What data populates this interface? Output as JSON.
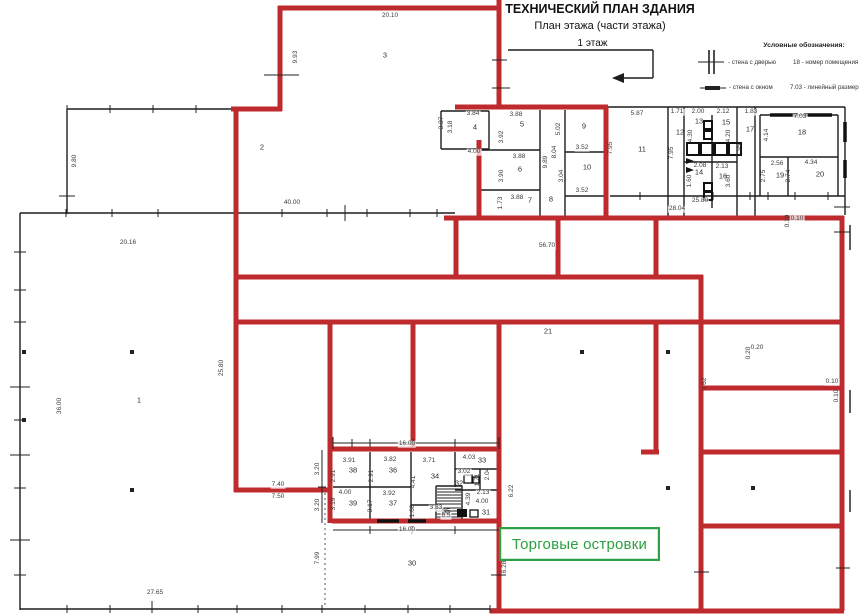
{
  "header": {
    "title": "ТЕХНИЧЕСКИЙ ПЛАН ЗДАНИЯ",
    "subtitle": "План этажа (части этажа)",
    "floor": "1 этаж"
  },
  "legend": {
    "title": "Условные обозначения:",
    "door_label": "- стена с дверью",
    "room_number_label": "18 - номер помещения",
    "window_label": "- стена с окном",
    "dimension_label": "7.03 - линейный размер"
  },
  "overlay": {
    "label": "Торговые островки"
  },
  "colors": {
    "wall_red": "#bf2a2e",
    "wall_black": "#1d1d1d",
    "green": "#2f9e44",
    "dim_text": "#3a3a3a"
  },
  "floor_plan": {
    "room_numbers": [
      {
        "t": "1",
        "x": 139,
        "y": 400
      },
      {
        "t": "2",
        "x": 262,
        "y": 147
      },
      {
        "t": "3",
        "x": 385,
        "y": 55
      },
      {
        "t": "4",
        "x": 475,
        "y": 127
      },
      {
        "t": "5",
        "x": 522,
        "y": 124
      },
      {
        "t": "6",
        "x": 520,
        "y": 169
      },
      {
        "t": "7",
        "x": 530,
        "y": 200
      },
      {
        "t": "8",
        "x": 551,
        "y": 199
      },
      {
        "t": "9",
        "x": 584,
        "y": 126
      },
      {
        "t": "10",
        "x": 587,
        "y": 167
      },
      {
        "t": "11",
        "x": 642,
        "y": 149
      },
      {
        "t": "12",
        "x": 680,
        "y": 132
      },
      {
        "t": "13",
        "x": 699,
        "y": 121
      },
      {
        "t": "14",
        "x": 699,
        "y": 172
      },
      {
        "t": "15",
        "x": 726,
        "y": 122
      },
      {
        "t": "16",
        "x": 723,
        "y": 176
      },
      {
        "t": "17",
        "x": 750,
        "y": 129
      },
      {
        "t": "18",
        "x": 802,
        "y": 132
      },
      {
        "t": "19",
        "x": 780,
        "y": 175
      },
      {
        "t": "20",
        "x": 820,
        "y": 174
      },
      {
        "t": "21",
        "x": 548,
        "y": 331
      },
      {
        "t": "30",
        "x": 412,
        "y": 563
      },
      {
        "t": "31",
        "x": 486,
        "y": 512
      },
      {
        "t": "32",
        "x": 459,
        "y": 483
      },
      {
        "t": "33",
        "x": 482,
        "y": 460
      },
      {
        "t": "34",
        "x": 435,
        "y": 476
      },
      {
        "t": "35",
        "x": 446,
        "y": 511
      },
      {
        "t": "36",
        "x": 393,
        "y": 470
      },
      {
        "t": "37",
        "x": 393,
        "y": 503
      },
      {
        "t": "38",
        "x": 353,
        "y": 470
      },
      {
        "t": "39",
        "x": 353,
        "y": 503
      }
    ],
    "dimensions": [
      {
        "t": "20.10",
        "x": 390,
        "y": 16
      },
      {
        "t": "9.93",
        "x": 296,
        "y": 57,
        "r": 1
      },
      {
        "t": "3.84",
        "x": 473,
        "y": 114
      },
      {
        "t": "3.37",
        "x": 442,
        "y": 123,
        "r": 1
      },
      {
        "t": "3.18",
        "x": 451,
        "y": 127,
        "r": 1
      },
      {
        "t": "4.00",
        "x": 474,
        "y": 152
      },
      {
        "t": "3.88",
        "x": 516,
        "y": 115
      },
      {
        "t": "3.92",
        "x": 502,
        "y": 137,
        "r": 1
      },
      {
        "t": "3.88",
        "x": 519,
        "y": 157
      },
      {
        "t": "3.90",
        "x": 502,
        "y": 176,
        "r": 1
      },
      {
        "t": "3.88",
        "x": 517,
        "y": 198
      },
      {
        "t": "1.73",
        "x": 501,
        "y": 203,
        "r": 1
      },
      {
        "t": "9.89",
        "x": 546,
        "y": 162,
        "r": 1
      },
      {
        "t": "5.02",
        "x": 559,
        "y": 129,
        "r": 1
      },
      {
        "t": "8.04",
        "x": 555,
        "y": 152,
        "r": 1
      },
      {
        "t": "3.52",
        "x": 582,
        "y": 148
      },
      {
        "t": "3.04",
        "x": 562,
        "y": 176,
        "r": 1
      },
      {
        "t": "3.52",
        "x": 582,
        "y": 191
      },
      {
        "t": "40.00",
        "x": 292,
        "y": 203
      },
      {
        "t": "20.16",
        "x": 128,
        "y": 243
      },
      {
        "t": "9.80",
        "x": 75,
        "y": 161,
        "r": 1
      },
      {
        "t": "5.87",
        "x": 637,
        "y": 114
      },
      {
        "t": "1.71",
        "x": 677,
        "y": 112
      },
      {
        "t": "2.00",
        "x": 698,
        "y": 112
      },
      {
        "t": "2.12",
        "x": 723,
        "y": 112
      },
      {
        "t": "1.83",
        "x": 751,
        "y": 112
      },
      {
        "t": "7.03",
        "x": 800,
        "y": 117
      },
      {
        "t": "7.95",
        "x": 611,
        "y": 148,
        "r": 1
      },
      {
        "t": "7.95",
        "x": 672,
        "y": 153,
        "r": 1
      },
      {
        "t": "7.95",
        "x": 740,
        "y": 150,
        "r": 1
      },
      {
        "t": "4.30",
        "x": 691,
        "y": 136,
        "r": 1
      },
      {
        "t": "4.20",
        "x": 729,
        "y": 136,
        "r": 1
      },
      {
        "t": "4.14",
        "x": 767,
        "y": 135,
        "r": 1
      },
      {
        "t": "2.08",
        "x": 700,
        "y": 166
      },
      {
        "t": "2.13",
        "x": 722,
        "y": 167
      },
      {
        "t": "1.60",
        "x": 690,
        "y": 181,
        "r": 1
      },
      {
        "t": "3.60",
        "x": 729,
        "y": 181,
        "r": 1
      },
      {
        "t": "2.56",
        "x": 777,
        "y": 164
      },
      {
        "t": "4.34",
        "x": 811,
        "y": 163
      },
      {
        "t": "2.75",
        "x": 764,
        "y": 176,
        "r": 1
      },
      {
        "t": "2.74",
        "x": 789,
        "y": 176,
        "r": 1
      },
      {
        "t": "25.80",
        "x": 700,
        "y": 201
      },
      {
        "t": "28.04",
        "x": 677,
        "y": 209
      },
      {
        "t": "56.70",
        "x": 547,
        "y": 246
      },
      {
        "t": "0.10",
        "x": 797,
        "y": 219
      },
      {
        "t": "0.10",
        "x": 788,
        "y": 221,
        "r": 1
      },
      {
        "t": "0.20",
        "x": 757,
        "y": 348
      },
      {
        "t": "0.20",
        "x": 749,
        "y": 353,
        "r": 1
      },
      {
        "t": "0.62",
        "x": 705,
        "y": 384,
        "r": 1
      },
      {
        "t": "0.10",
        "x": 832,
        "y": 382
      },
      {
        "t": "0.10",
        "x": 837,
        "y": 396,
        "r": 1
      },
      {
        "t": "36.00",
        "x": 60,
        "y": 406,
        "r": 1
      },
      {
        "t": "25.80",
        "x": 222,
        "y": 368,
        "r": 1
      },
      {
        "t": "7.40",
        "x": 278,
        "y": 485
      },
      {
        "t": "7.50",
        "x": 278,
        "y": 497
      },
      {
        "t": "3.20",
        "x": 318,
        "y": 469,
        "r": 1
      },
      {
        "t": "3.20",
        "x": 318,
        "y": 505,
        "r": 1
      },
      {
        "t": "3.91",
        "x": 349,
        "y": 461
      },
      {
        "t": "2.91",
        "x": 334,
        "y": 476,
        "r": 1
      },
      {
        "t": "3.82",
        "x": 390,
        "y": 460
      },
      {
        "t": "2.91",
        "x": 372,
        "y": 476,
        "r": 1
      },
      {
        "t": "3.71",
        "x": 429,
        "y": 461
      },
      {
        "t": "4.41",
        "x": 414,
        "y": 482,
        "r": 1
      },
      {
        "t": "4.03",
        "x": 469,
        "y": 458
      },
      {
        "t": "3.02",
        "x": 464,
        "y": 472
      },
      {
        "t": "2.04",
        "x": 488,
        "y": 474,
        "r": 1
      },
      {
        "t": "1.71",
        "x": 478,
        "y": 480,
        "r": 1
      },
      {
        "t": "2.13",
        "x": 483,
        "y": 493
      },
      {
        "t": "4.00",
        "x": 482,
        "y": 502
      },
      {
        "t": "4.39",
        "x": 469,
        "y": 499,
        "r": 1
      },
      {
        "t": "3.83",
        "x": 436,
        "y": 508
      },
      {
        "t": "6.5",
        "x": 446,
        "y": 516
      },
      {
        "t": "1.68",
        "x": 413,
        "y": 511,
        "r": 1
      },
      {
        "t": "4.00",
        "x": 345,
        "y": 493
      },
      {
        "t": "3.19",
        "x": 334,
        "y": 504,
        "r": 1
      },
      {
        "t": "3.92",
        "x": 389,
        "y": 494
      },
      {
        "t": "3.17",
        "x": 371,
        "y": 506,
        "r": 1
      },
      {
        "t": "16.00",
        "x": 407,
        "y": 444
      },
      {
        "t": "16.00",
        "x": 407,
        "y": 530
      },
      {
        "t": "6.22",
        "x": 512,
        "y": 491,
        "r": 1
      },
      {
        "t": "6.28",
        "x": 505,
        "y": 567,
        "r": 1
      },
      {
        "t": "7.99",
        "x": 318,
        "y": 558,
        "r": 1
      },
      {
        "t": "27.65",
        "x": 155,
        "y": 593
      }
    ]
  }
}
